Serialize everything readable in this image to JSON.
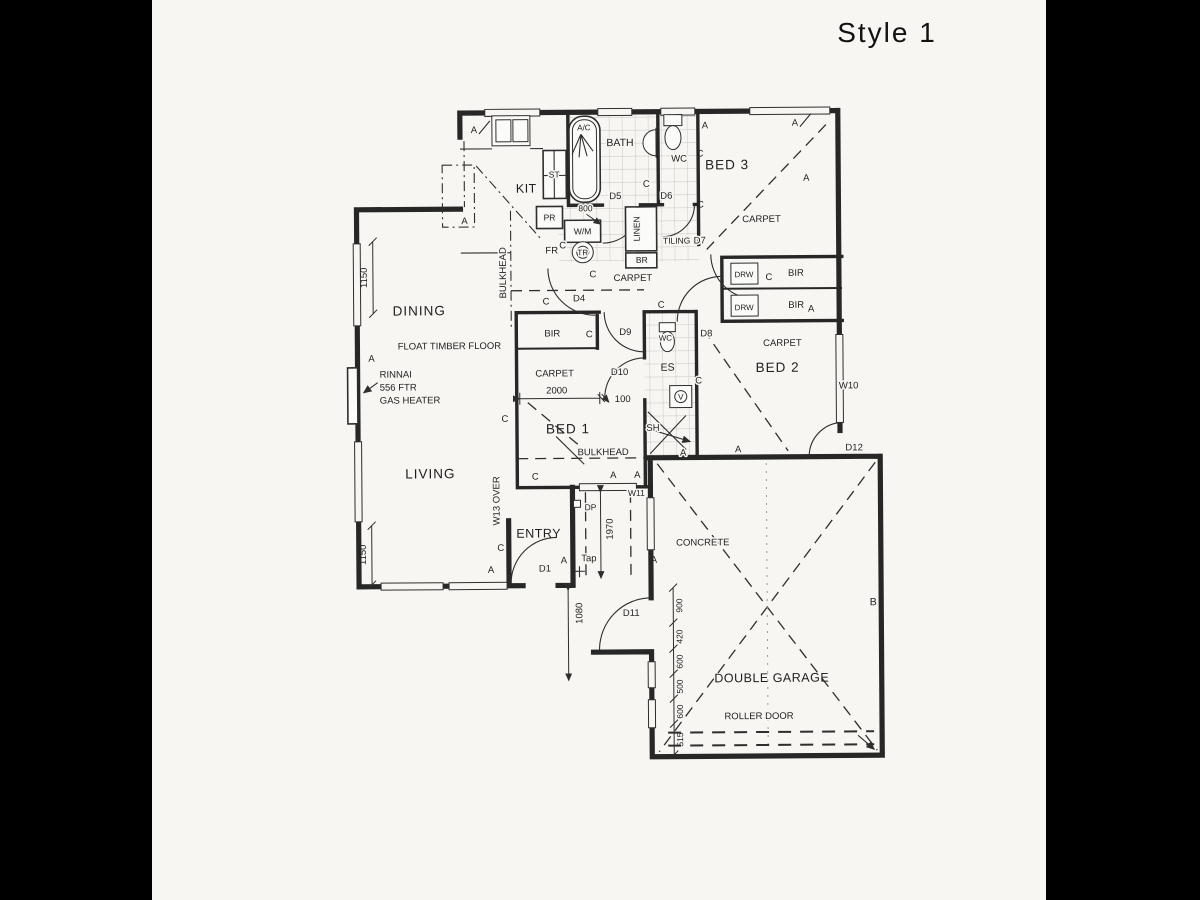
{
  "window_title": "Style 1",
  "rooms": {
    "kit": "KIT",
    "bath": "BATH",
    "wc": "WC",
    "bed3": "BED 3",
    "bed2": "BED 2",
    "bed1": "BED 1",
    "dining": "DINING",
    "living": "LIVING",
    "entry": "ENTRY",
    "ensuite": "ES",
    "garage": "DOUBLE GARAGE",
    "concrete": "CONCRETE"
  },
  "finishes": {
    "carpet": "CARPET",
    "tiling": "TILING",
    "timber": "FLOAT TIMBER FLOOR",
    "bulkhead": "BULKHEAD",
    "roller_door": "ROLLER DOOR",
    "linen": "LINEN"
  },
  "fixtures": {
    "st": "ST",
    "pr": "PR",
    "fr": "FR",
    "br": "BR",
    "wm": "W/M",
    "tr": "TR",
    "sh": "SH",
    "vanity": "V",
    "wc": "WC",
    "tap": "Tap",
    "dp": "DP",
    "ac": "A/C",
    "drw": "DRW",
    "bir": "BIR"
  },
  "heater": {
    "line1": "RINNAI",
    "line2": "556 FTR",
    "line3": "GAS HEATER"
  },
  "doors": {
    "d1": "D1",
    "d4": "D4",
    "d5": "D5",
    "d6": "D6",
    "d7": "D7",
    "d8": "D8",
    "d9": "D9",
    "d10": "D10",
    "d11": "D11",
    "d12": "D12"
  },
  "windows": {
    "w10": "W10",
    "w11": "W11",
    "w13": "W13 OVER"
  },
  "dims": {
    "n1150": "1150",
    "n2000": "2000",
    "n100": "100",
    "n800": "800",
    "n1970": "1970",
    "n1080": "1080",
    "n900": "900",
    "n420": "420",
    "n600": "600",
    "n500": "500",
    "n515": "515"
  },
  "marks": {
    "a": "A",
    "b": "B",
    "c": "C"
  },
  "colors": {
    "paper": "#f7f6f3",
    "ink": "#272727",
    "bars": "#000000"
  }
}
